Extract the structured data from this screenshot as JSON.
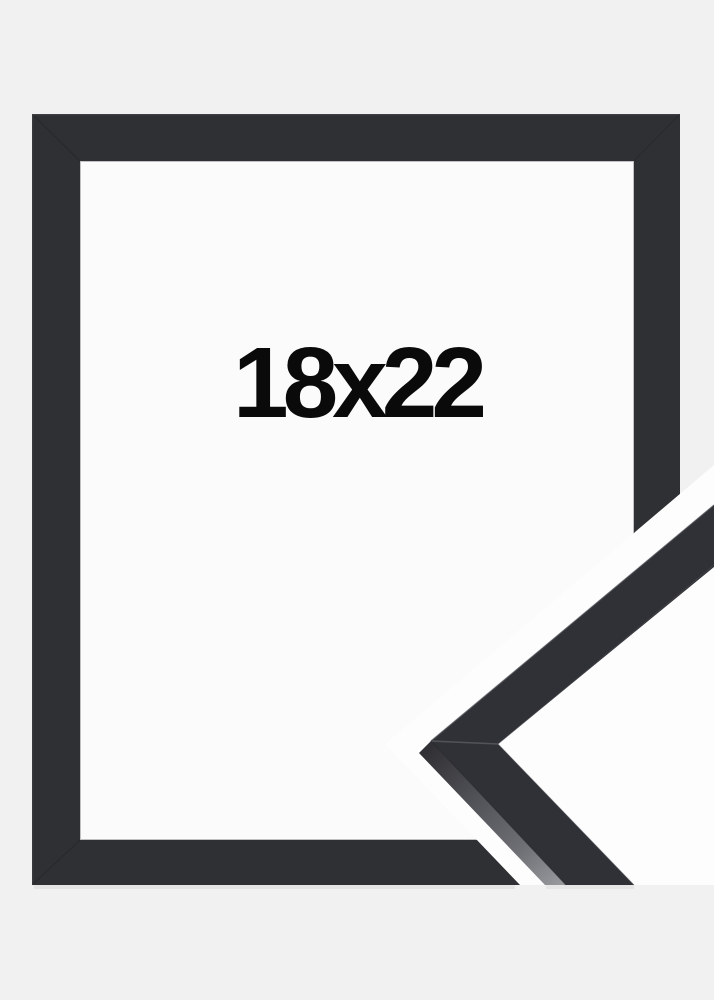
{
  "product_image": {
    "size_label": "18x22"
  },
  "colors": {
    "background": "#f1f1f2",
    "frame_black": "#2f3033",
    "opening_white": "#fbfbfc",
    "cutout_white": "#fdfdfe",
    "sample_front_black": "#303136",
    "label_text": "#0a0a0b"
  }
}
